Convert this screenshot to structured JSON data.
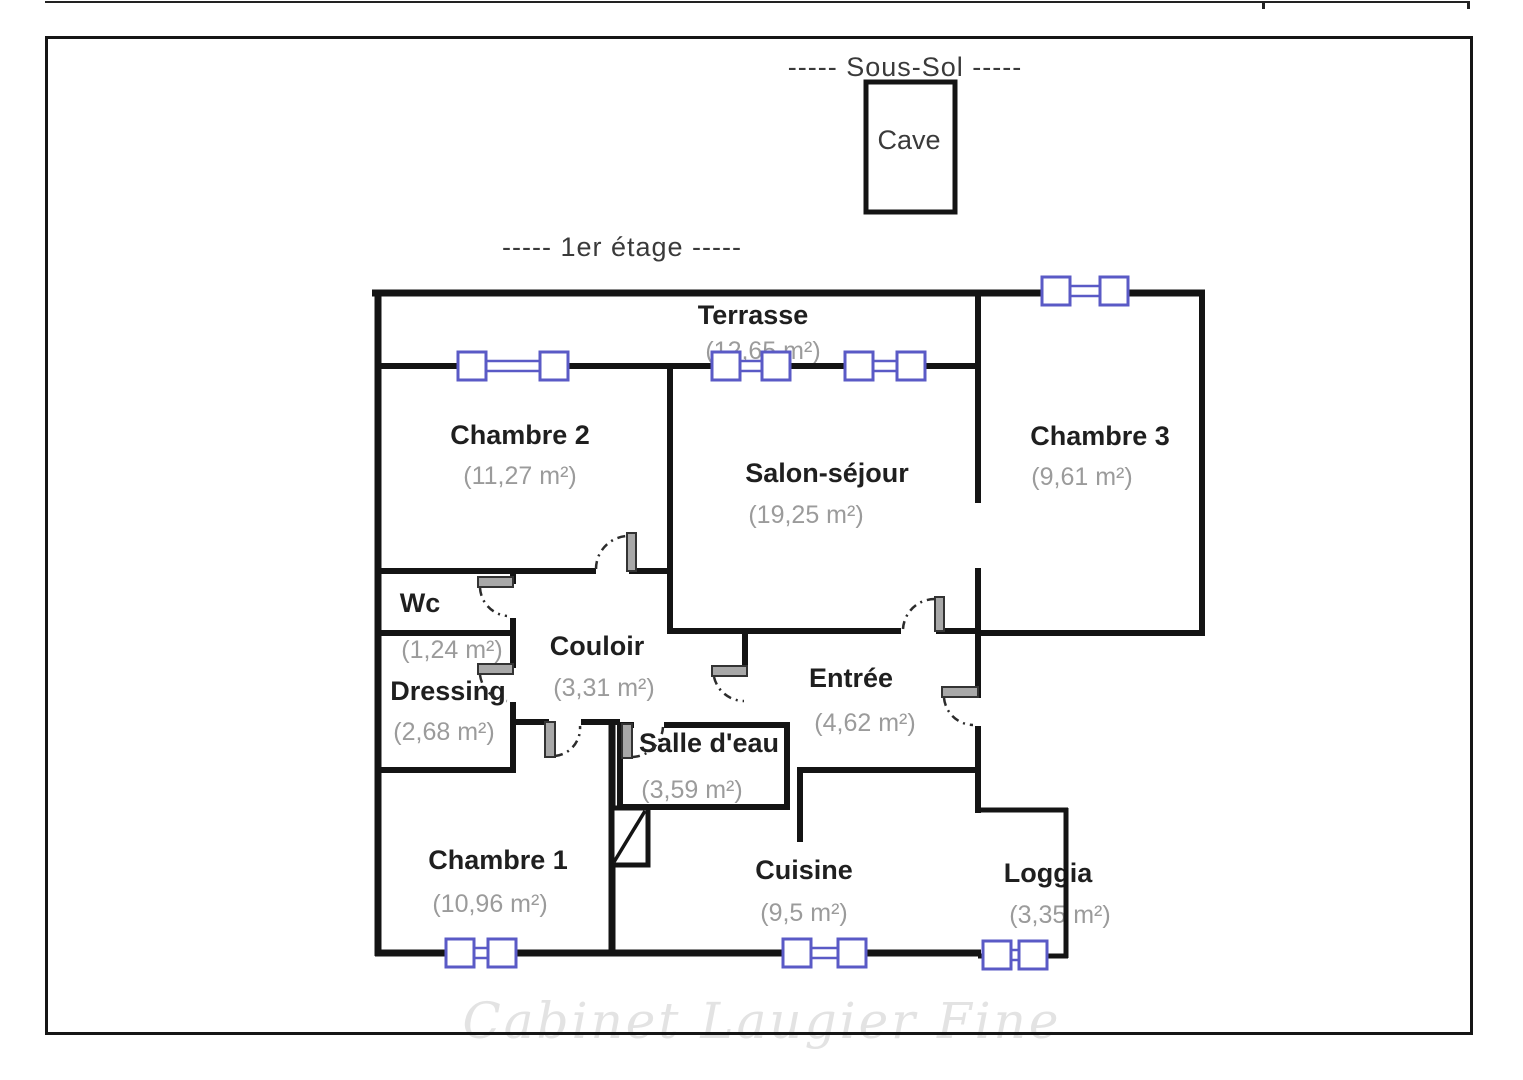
{
  "colors": {
    "wall": "#141414",
    "window": "#5a5ac6",
    "room_name": "#1f1f1f",
    "room_area": "#9b9b9b",
    "watermark": "#e3e3e3"
  },
  "floors": {
    "sous_sol_title": "-----  Sous-Sol  -----",
    "premier_title": "-----  1er étage  -----"
  },
  "rooms": {
    "cave": {
      "name": "Cave"
    },
    "terrasse": {
      "name": "Terrasse",
      "area": "(12,65 m²)"
    },
    "chambre2": {
      "name": "Chambre 2",
      "area": "(11,27 m²)"
    },
    "salon": {
      "name": "Salon-séjour",
      "area": "(19,25 m²)"
    },
    "chambre3": {
      "name": "Chambre 3",
      "area": "(9,61 m²)"
    },
    "wc": {
      "name": "Wc",
      "area": "(1,24 m²)"
    },
    "couloir": {
      "name": "Couloir",
      "area": "(3,31 m²)"
    },
    "dressing": {
      "name": "Dressing",
      "area": "(2,68 m²)"
    },
    "entree": {
      "name": "Entrée",
      "area": "(4,62 m²)"
    },
    "salle_eau": {
      "name": "Salle d'eau",
      "area": "(3,59 m²)"
    },
    "chambre1": {
      "name": "Chambre 1",
      "area": "(10,96 m²)"
    },
    "cuisine": {
      "name": "Cuisine",
      "area": "(9,5 m²)"
    },
    "loggia": {
      "name": "Loggia",
      "area": "(3,35 m²)"
    }
  },
  "watermark": {
    "text": "Cabinet Laugier Fine"
  }
}
